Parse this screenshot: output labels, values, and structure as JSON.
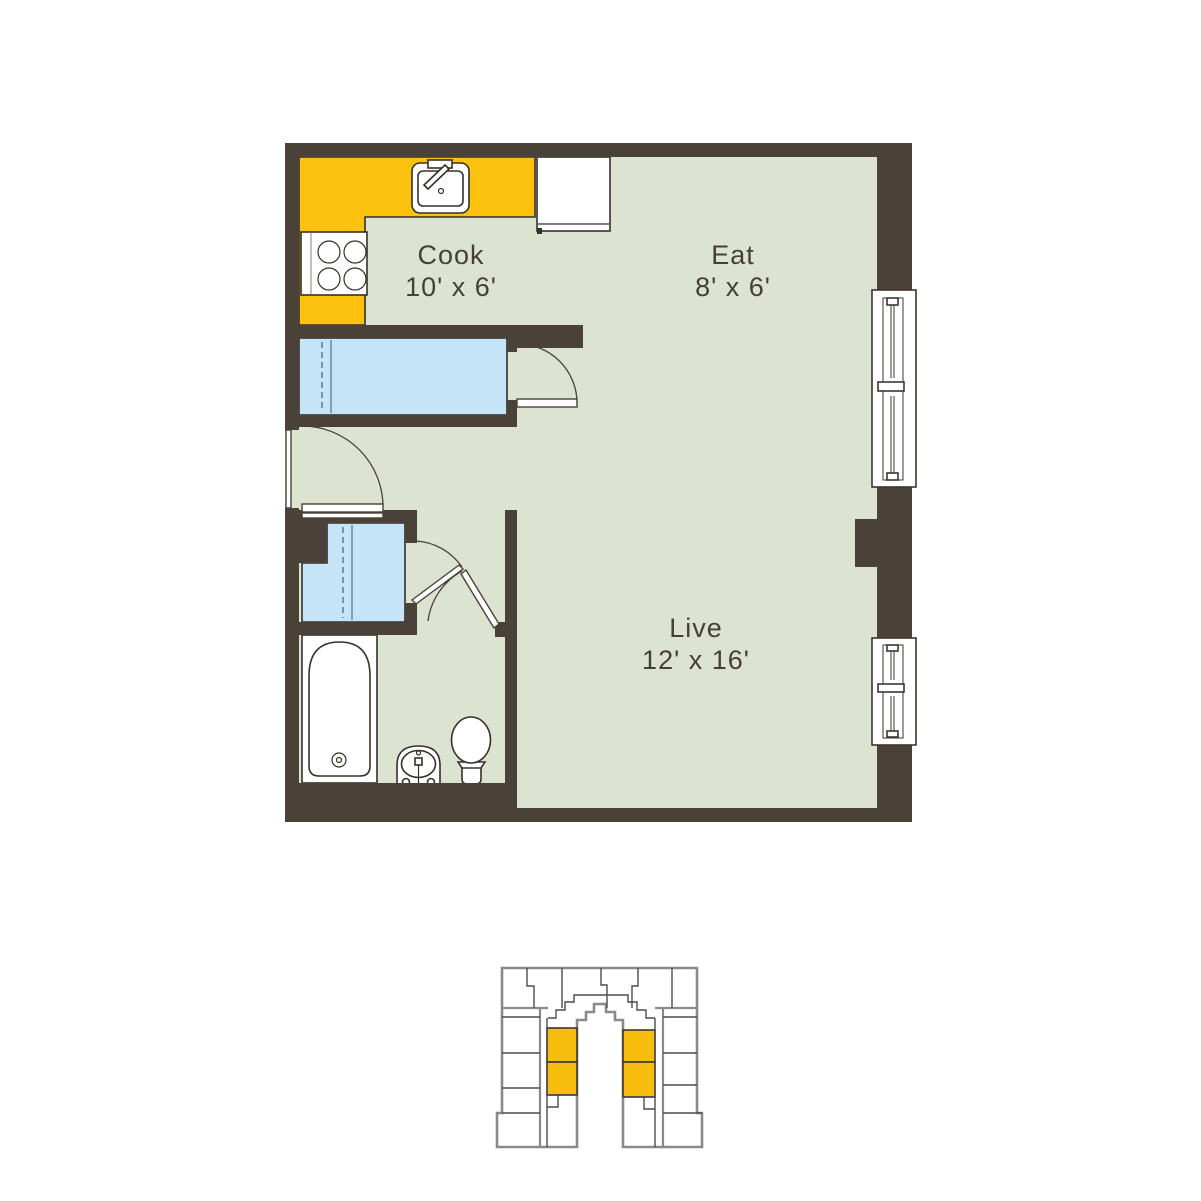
{
  "title": "Studio apartment floor plan",
  "colors": {
    "wall": "#4a4138",
    "floor": "#dde3d1",
    "counter": "#fdc20e",
    "closet": "#c5e4f7",
    "outline": "#35302a",
    "text": "#453f38",
    "kpline": "#8a8a8a",
    "kpdiv": "#4c4c4c",
    "highlight": "#f6bd0f"
  },
  "rooms": {
    "cook": {
      "name": "Cook",
      "dimensions": "10' x 6'"
    },
    "eat": {
      "name": "Eat",
      "dimensions": "8' x 6'"
    },
    "live": {
      "name": "Live",
      "dimensions": "12' x 16'"
    }
  },
  "fixtures": [
    "kitchen-sink",
    "stove",
    "refrigerator",
    "kitchen-counter",
    "closet",
    "wardrobe-closet",
    "bathtub",
    "pedestal-sink",
    "toilet",
    "entry-door",
    "window"
  ],
  "keyplan": {
    "description": "building-footprint-key-plan",
    "highlighted_unit_count": 4
  }
}
